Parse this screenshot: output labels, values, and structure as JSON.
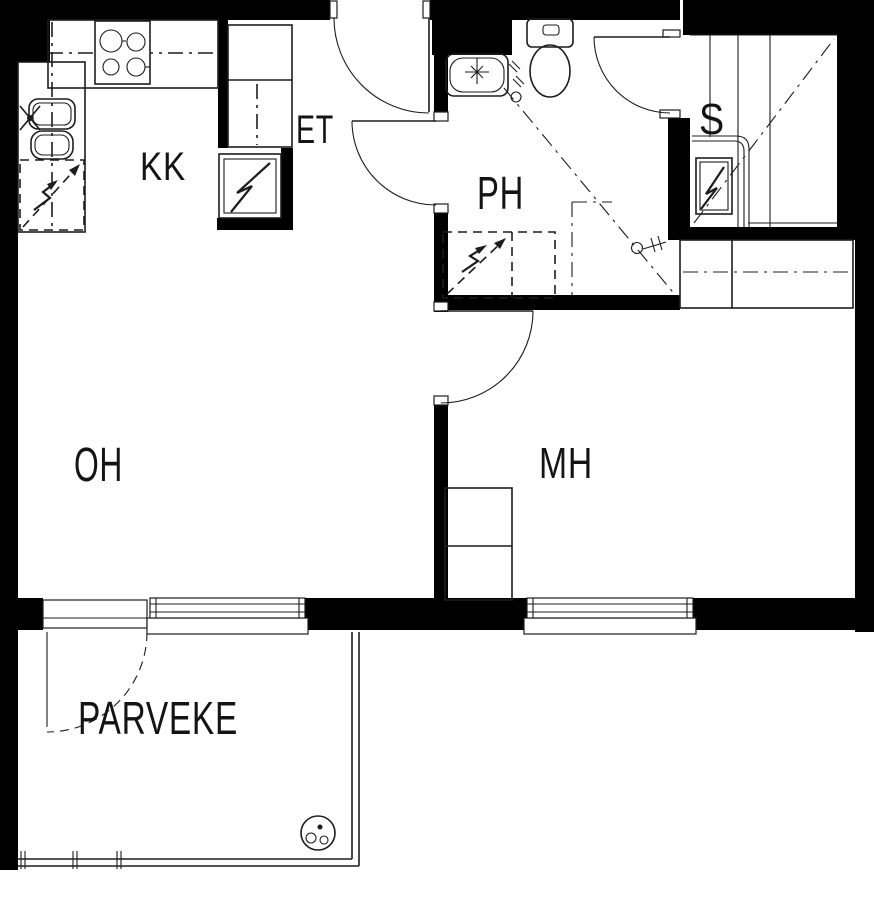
{
  "floor_plan": {
    "rooms": {
      "kk": {
        "label": "KK"
      },
      "et": {
        "label": "ET"
      },
      "ph": {
        "label": "PH"
      },
      "s": {
        "label": "S"
      },
      "oh": {
        "label": "OH"
      },
      "mh": {
        "label": "MH"
      },
      "parveke": {
        "label": "PARVEKE"
      }
    },
    "fixtures": [
      "stove-icon",
      "kitchen-sink-icon",
      "dishwasher-reservation-icon",
      "refrigerator-icon",
      "coat-closet-icon",
      "washbasin-icon",
      "toilet-icon",
      "washing-machine-reservation-icon",
      "shower-valve-icon",
      "sauna-stove-icon",
      "sauna-bench-icon",
      "wardrobe-icon",
      "window-icon",
      "door-swing-icon",
      "balcony-railing-icon",
      "balcony-drain-icon"
    ],
    "colors": {
      "wall": "#000000",
      "line": "#1d1d1d",
      "background": "#ffffff"
    }
  }
}
